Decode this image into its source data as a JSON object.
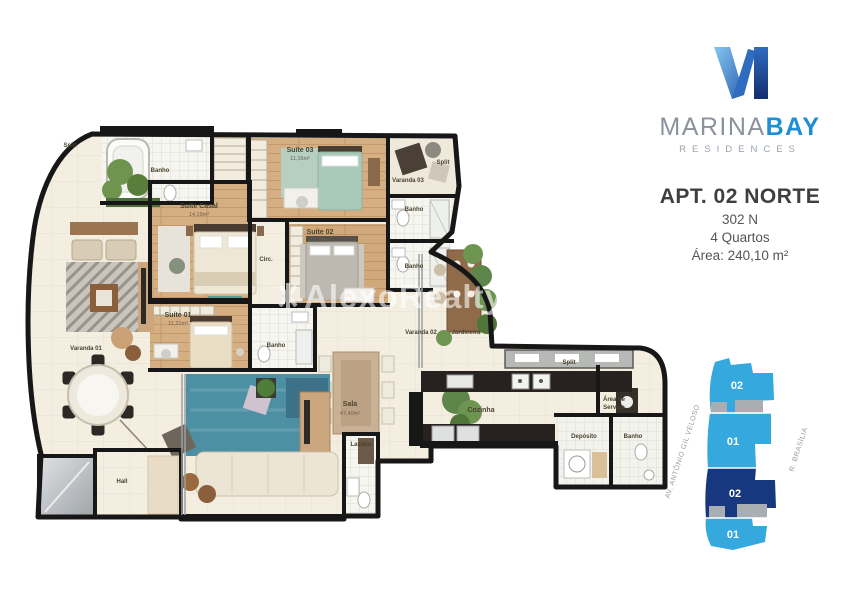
{
  "branding": {
    "logo_mark": "M",
    "name_gray": "MARINA",
    "name_blue": "BAY",
    "subtitle": "RESIDENCES",
    "colors": {
      "logo_light": "#86c6ee",
      "logo_dark": "#142e6e",
      "bay_blue": "#1e8fd5"
    }
  },
  "apartment": {
    "title": "APT. 02 NORTE",
    "unit_number": "302 N",
    "bedrooms": "4 Quartos",
    "area": "Área: 240,10 m²"
  },
  "watermark": "AlexoRealty",
  "keyplan": {
    "units": [
      "02",
      "01",
      "02",
      "01"
    ],
    "highlighted_unit": "02",
    "street_left": "AV. ANTÔNIO GIL VELOSO",
    "street_right": "R. BRASÍLIA",
    "colors": {
      "light": "#35a8dd",
      "dark": "#17377e",
      "core": "#a9aeb2"
    }
  },
  "plan": {
    "labels": {
      "split_top_left": "Split",
      "banho_casal": "Banho",
      "suite_casal_name": "Suíte Casal",
      "suite_casal_area": "14,19m²",
      "suite03_name": "Suíte 03",
      "suite03_area": "11,16m²",
      "varanda03": "Varanda 03",
      "split_top_right": "Split",
      "banho_suite03": "Banho",
      "banho_suite02": "Banho",
      "suite02_name": "Suíte 02",
      "suite02_area": "10,10m²",
      "circ": "Circ.",
      "suite01_name": "Suíte 01",
      "suite01_area": "11,21m²",
      "banho_suite01": "Banho",
      "varanda01": "Varanda 01",
      "sala_name": "Sala",
      "sala_area": "47,40m²",
      "lavabo": "Lavabo",
      "varanda02": "Varanda 02",
      "jardineira": "Jardineira",
      "split_kitchen": "Split",
      "cozinha": "Cozinha",
      "area_servico_line1": "Área de",
      "area_servico_line2": "Serviço",
      "deposito": "Depósito",
      "banho_servico": "Banho",
      "hall": "Hall"
    }
  }
}
